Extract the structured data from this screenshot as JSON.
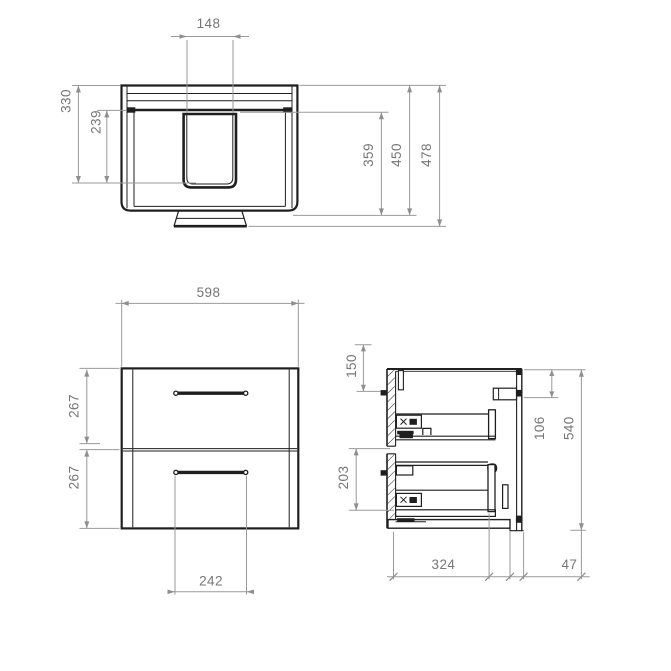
{
  "title": "Wall-hung vanity unit dimensional drawing",
  "colors": {
    "background": "#ffffff",
    "object_line": "#1f1f1f",
    "dimension_line": "#9a9a9a",
    "dimension_text": "#767676"
  },
  "dims": {
    "basin_cutout_width": "148",
    "basin_back_depth": "330",
    "basin_front_depth": "239",
    "cutout_to_front_depth": "359",
    "body_depth": "450",
    "overall_depth": "478",
    "body_width": "598",
    "upper_drawer_front_height": "267",
    "lower_drawer_front_height": "267",
    "handle_width": "242",
    "top_to_fixing_height": "150",
    "lower_drawer_inner_height": "203",
    "bracket_drop_height": "106",
    "body_height": "540",
    "drawer_inner_depth": "324",
    "wall_clearance": "47"
  }
}
